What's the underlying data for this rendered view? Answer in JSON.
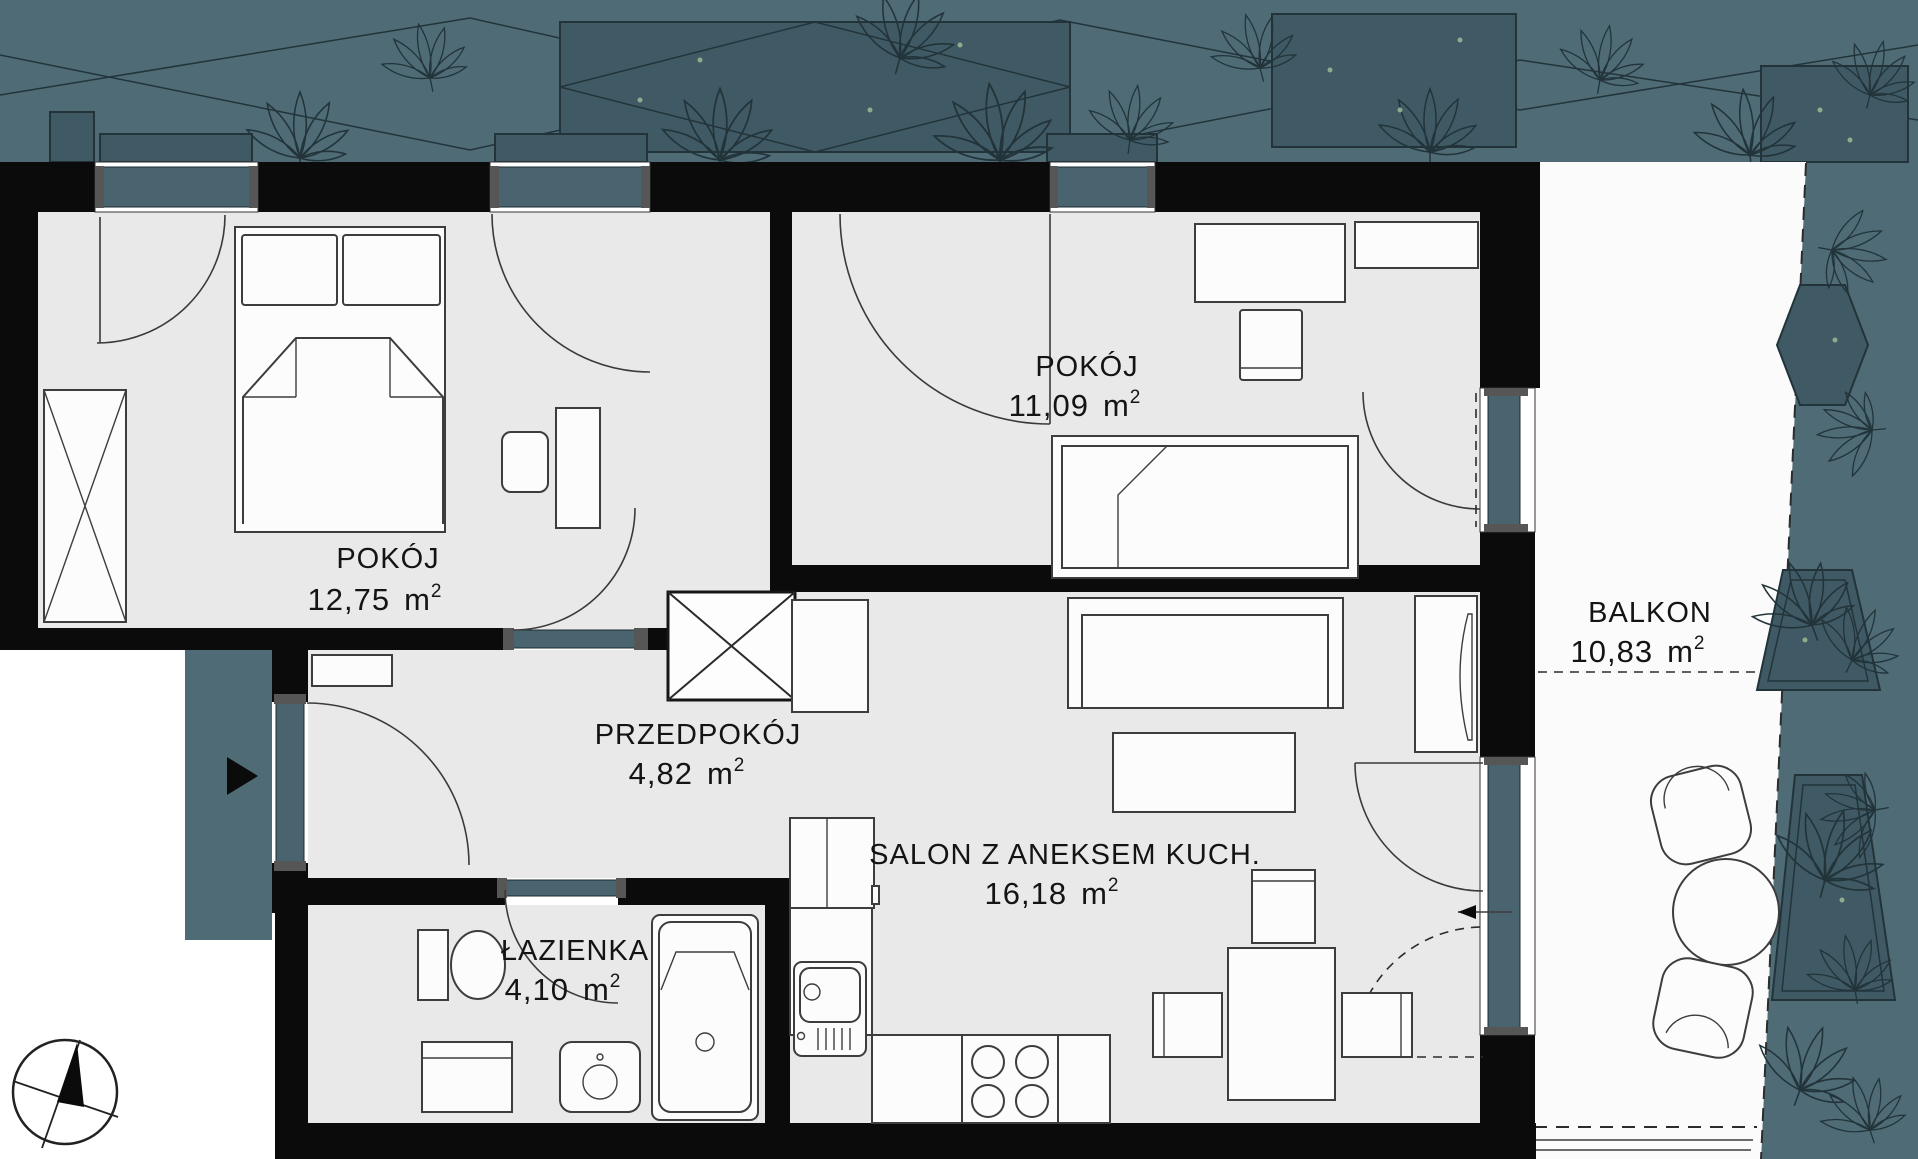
{
  "plan": {
    "rooms": [
      {
        "id": "pokoj1",
        "name": "POKÓJ",
        "area": "12,75",
        "unit": "m",
        "unit_sup": "2"
      },
      {
        "id": "pokoj2",
        "name": "POKÓJ",
        "area": "11,09",
        "unit": "m",
        "unit_sup": "2"
      },
      {
        "id": "przedpokoj",
        "name": "PRZEDPOKÓJ",
        "area": "4,82",
        "unit": "m",
        "unit_sup": "2"
      },
      {
        "id": "salon",
        "name": "SALON Z ANEKSEM KUCH.",
        "area": "16,18",
        "unit": "m",
        "unit_sup": "2"
      },
      {
        "id": "lazienka",
        "name": "ŁAZIENKA",
        "area": "4,10",
        "unit": "m",
        "unit_sup": "2"
      },
      {
        "id": "balkon",
        "name": "BALKON",
        "area": "10,83",
        "unit": "m",
        "unit_sup": "2"
      }
    ],
    "markers": {
      "entrance_arrow": "right-pointing-triangle",
      "compass": "compass-rose"
    },
    "colors": {
      "outdoor_teal": "#4e6b76",
      "glass_teal": "#49646f",
      "planter_teal": "#3f5a64",
      "floor": "#e9e9e9",
      "wall": "#0b0b0b",
      "plant_line": "#22343a",
      "accent_green": "#9db894",
      "label": "#141414"
    }
  }
}
